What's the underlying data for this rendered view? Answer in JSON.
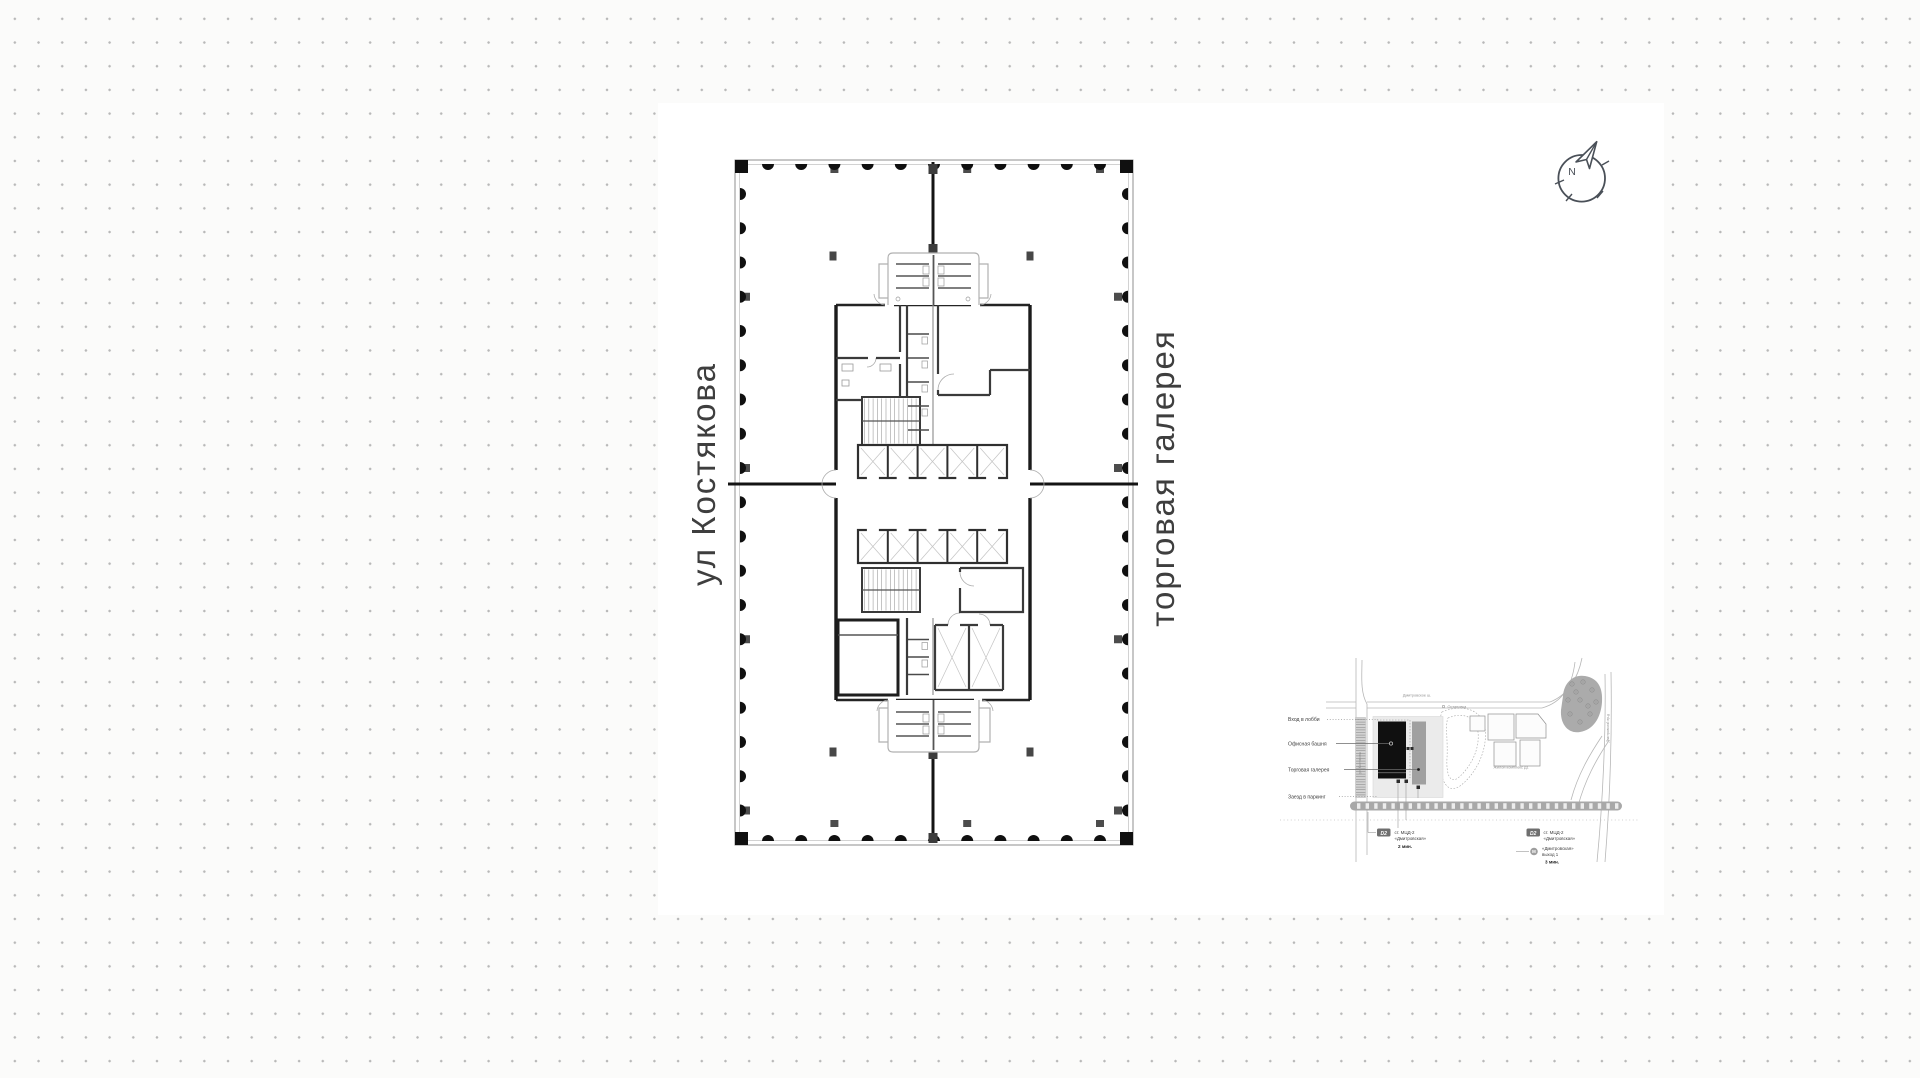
{
  "page": {
    "dot_color": "#b8b8b8"
  },
  "plan": {
    "street_label_left": "ул Костякова",
    "street_label_right": "торговая галерея"
  },
  "compass": {
    "north_label": "N"
  },
  "site_map": {
    "callout_entrance": "Вход в лобби",
    "callout_tower": "Офисная башня",
    "callout_gallery": "Торговая галерея",
    "callout_parking": "Заезд в паркинг",
    "street_top": "Дмитровское ш.",
    "bus_stop": "Остановка",
    "street_left": "ул. Костякова",
    "street_right": "Дмитровский пр-д",
    "residential": "Жилой комплекс Д1",
    "transit_left": {
      "badge": "D2",
      "line1": "ст. МЦД-2",
      "line2": "«Дмитровская»",
      "time": "2 мин."
    },
    "transit_right": {
      "badge": "D2",
      "line1": "ст. МЦД-2",
      "line2": "«Дмитровская»"
    },
    "transit_metro": {
      "badge": "М",
      "line1": "«Дмитровская»",
      "line2": "выход 1",
      "time": "3 мин."
    }
  }
}
